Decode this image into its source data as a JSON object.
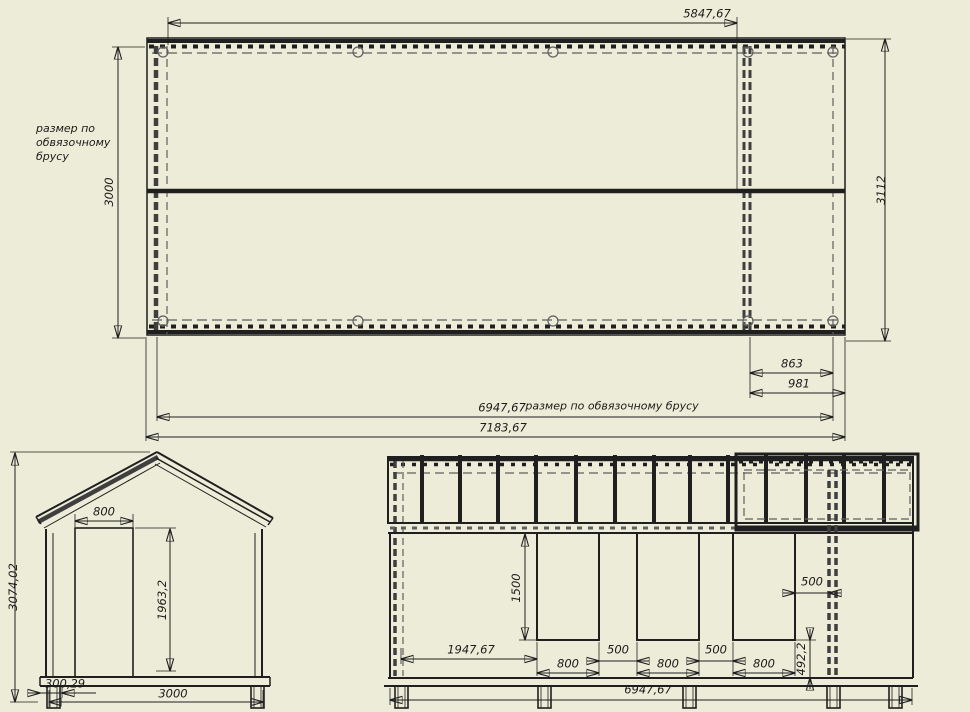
{
  "title": "timber frame technical drawing",
  "colors": {
    "background": "#edecd8",
    "ink": "#1f1f1f",
    "hidden_lines": "#5f5f5f"
  },
  "plan": {
    "width_top": "5847,67",
    "height_left": "3000",
    "height_right": "3112",
    "offset_small": "863",
    "offset_large": "981",
    "frame_width": "6947,67",
    "overall_width": "7183,67",
    "note_left": "размер по\nобвязочному\nбрусу",
    "note_bottom": "размер по обвязочному брусу"
  },
  "gable": {
    "overall_height": "3074,02",
    "door_width": "800",
    "door_height": "1963,2",
    "overhang": "300,29",
    "base_width": "3000"
  },
  "side": {
    "offset_left": "1947,67",
    "opening_width": "800",
    "gap": "500",
    "corner_gap": "500",
    "opening_height": "1500",
    "sill_height": "492,2",
    "frame_width": "6947,67"
  }
}
